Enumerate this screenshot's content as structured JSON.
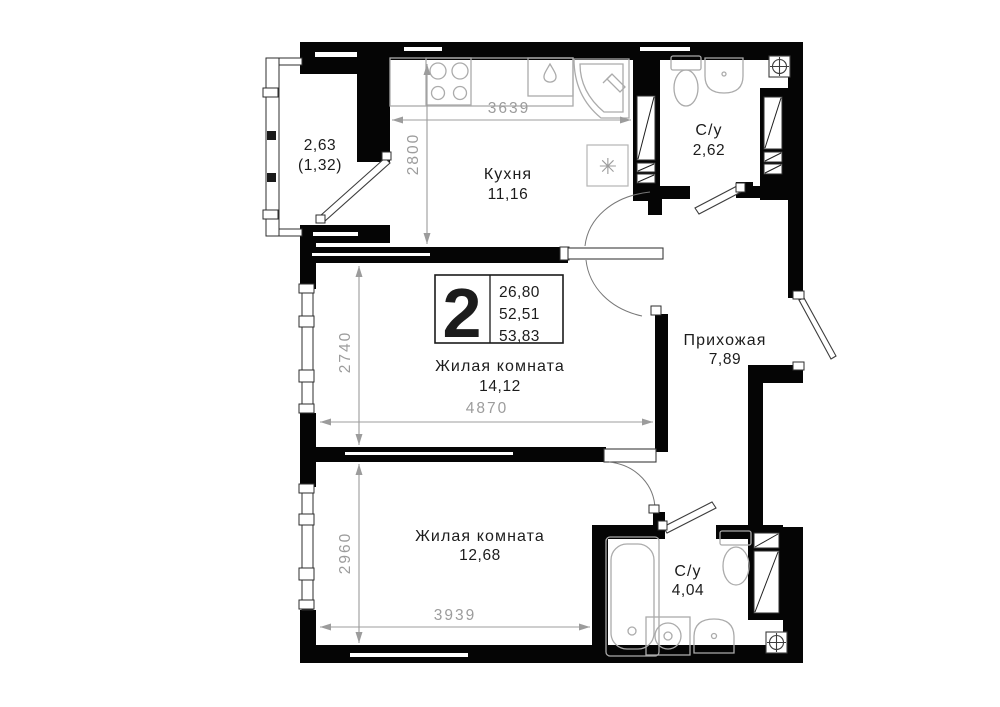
{
  "badge": {
    "rooms_count": "2",
    "areas": [
      "26,80",
      "52,51",
      "53,83"
    ]
  },
  "rooms": {
    "balcony": {
      "area": "2,63",
      "area_secondary": "(1,32)"
    },
    "kitchen": {
      "name": "Кухня",
      "area": "11,16"
    },
    "bathroom_top": {
      "name": "С/у",
      "area": "2,62"
    },
    "living_room_1": {
      "name": "Жилая комната",
      "area": "14,12"
    },
    "hallway": {
      "name": "Прихожая",
      "area": "7,89"
    },
    "living_room_2": {
      "name": "Жилая комната",
      "area": "12,68"
    },
    "bathroom_bottom": {
      "name": "С/у",
      "area": "4,04"
    }
  },
  "dimensions_mm": {
    "kitchen_width": "3639",
    "kitchen_depth": "2800",
    "living_room_1_depth": "2740",
    "living_room_1_width": "4870",
    "living_room_2_depth": "2960",
    "living_room_2_width": "3939"
  },
  "icons": {
    "fridge": "✳"
  },
  "colors": {
    "wall": "#050505",
    "dim_gray": "#9c9c9c",
    "fixture_gray": "#ababab",
    "label": "#1c1c1c",
    "background": "#ffffff"
  }
}
